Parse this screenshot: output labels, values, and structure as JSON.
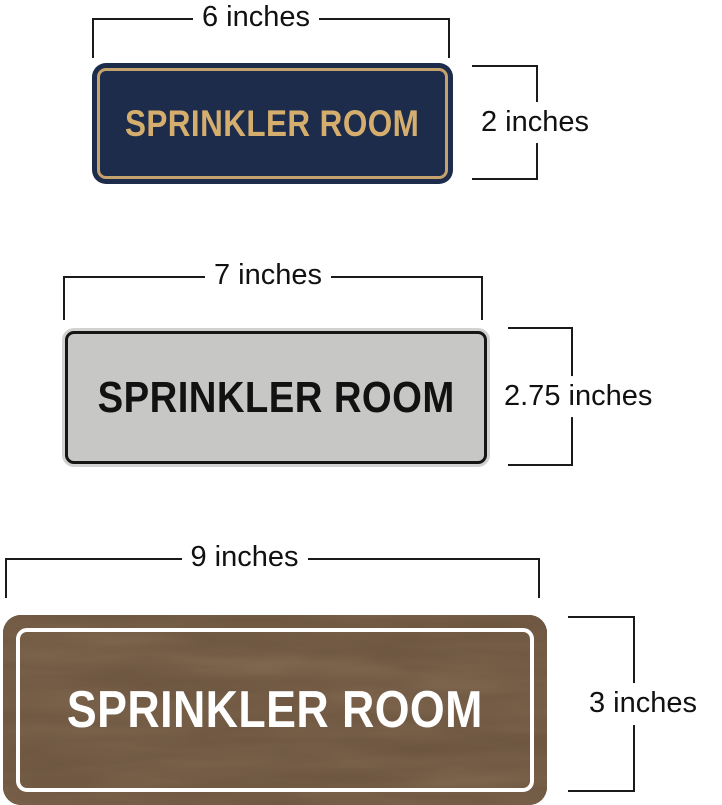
{
  "diagram": {
    "title": "sprinkler room sign size comparison",
    "background_color": "#ffffff",
    "dimension_line_color": "#1a1a1a"
  },
  "signs": {
    "navy": {
      "label": "SPRINKLER ROOM",
      "width_label": "6 inches",
      "height_label": "2 inches",
      "bg_color": "#1e2c4c",
      "border_color": "#c5a26b",
      "text_color": "#d5ae6e"
    },
    "silver": {
      "label": "SPRINKLER ROOM",
      "width_label": "7 inches",
      "height_label": "2.75 inches",
      "rim_color": "#d2d3d0",
      "bg_color": "#c7c8c5",
      "border_color": "#161616",
      "text_color": "#121212"
    },
    "walnut": {
      "label": "SPRINKLER ROOM",
      "width_label": "9 inches",
      "height_label": "3 inches",
      "bg_color": "#4a3423",
      "border_color": "#ffffff",
      "text_color": "#ffffff"
    }
  }
}
